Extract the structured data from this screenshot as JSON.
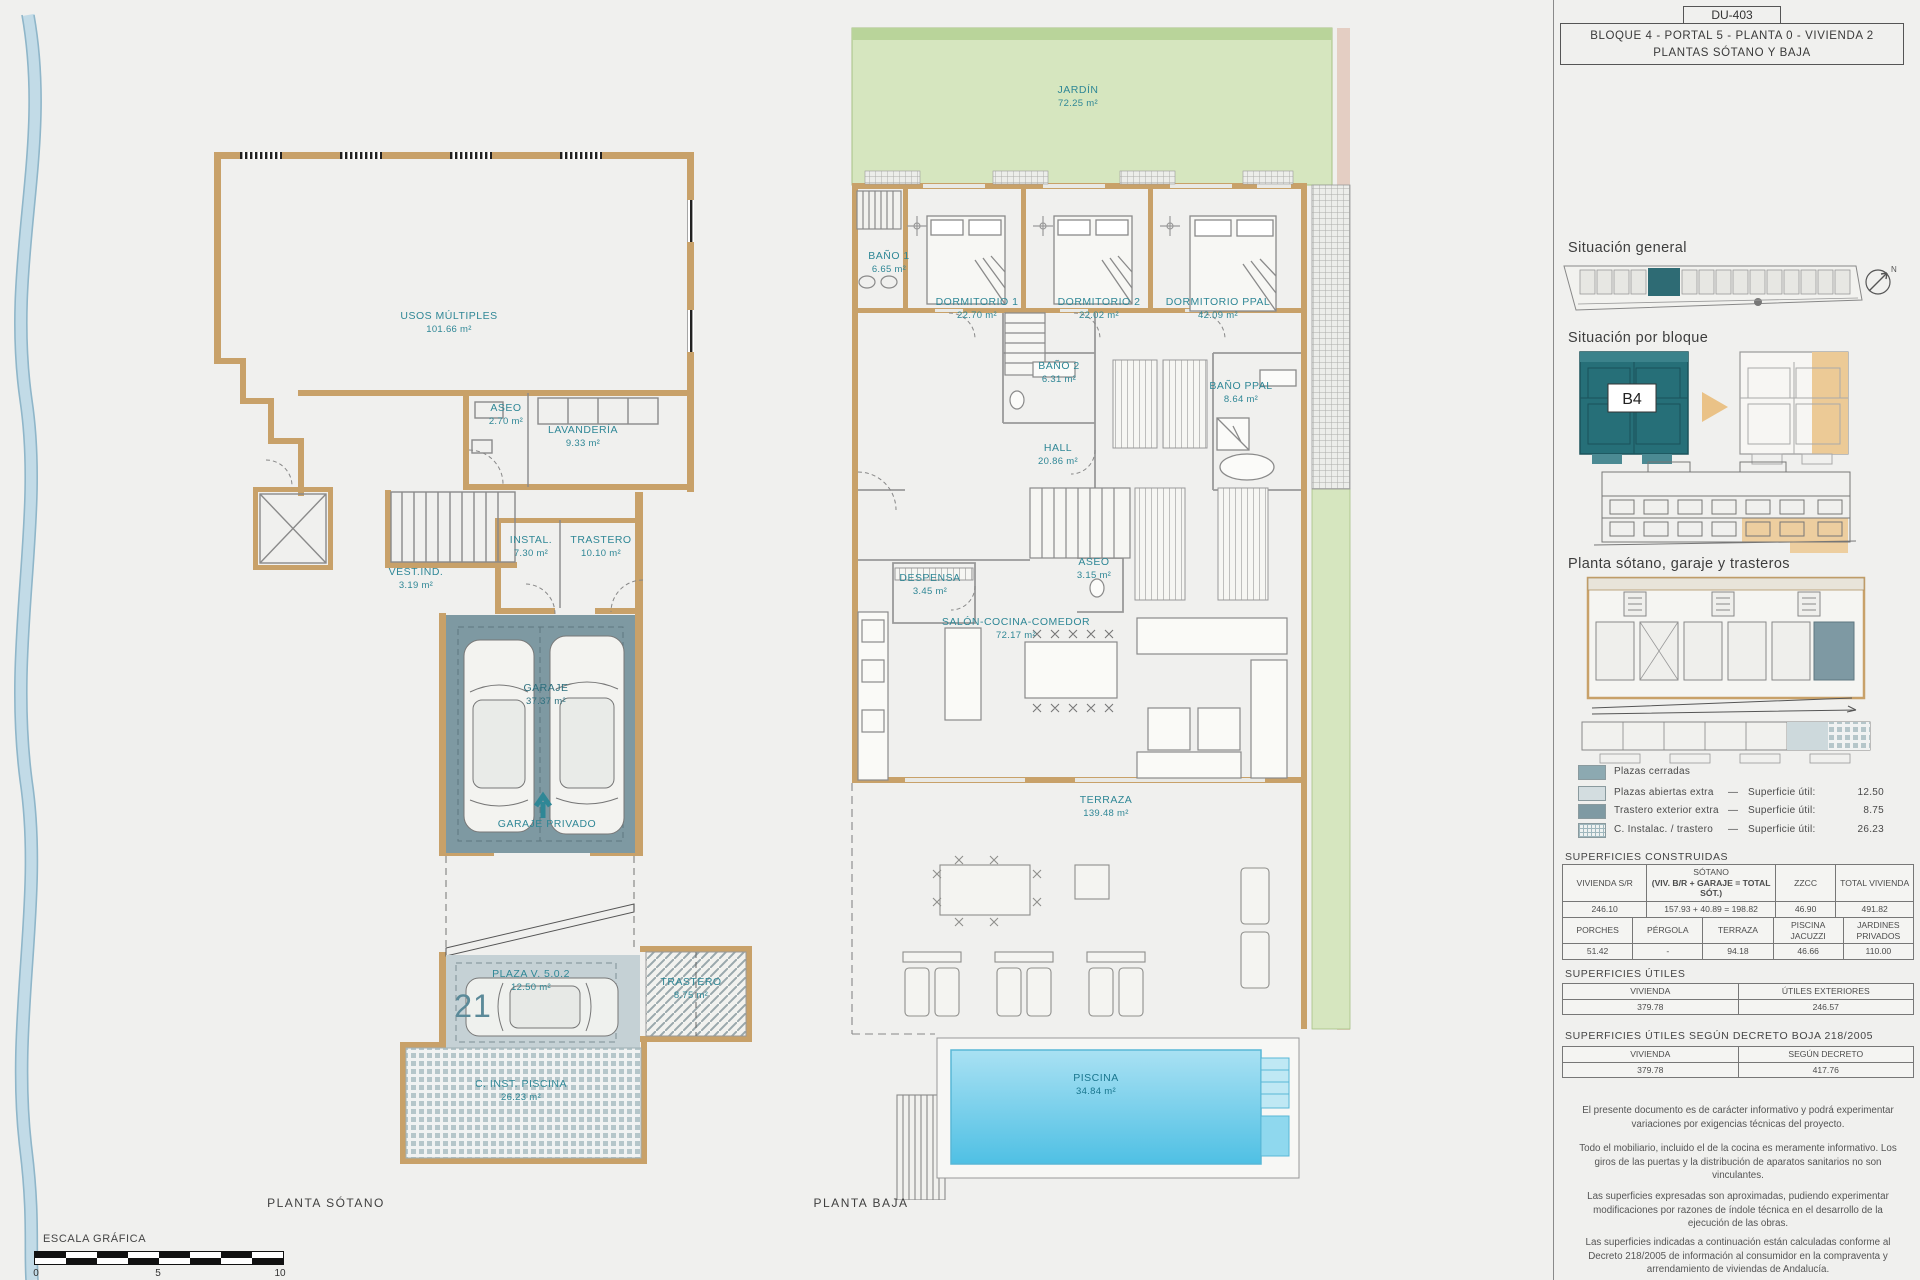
{
  "title_block": {
    "code": "DU-403",
    "line1": "BLOQUE 4 - PORTAL 5 - PLANTA 0 - VIVIENDA 2",
    "line2": "PLANTAS SÓTANO Y BAJA"
  },
  "sidebar": {
    "situacion_general_heading": "Situación general",
    "situacion_bloque_heading": "Situación por bloque",
    "bloque_label": "B4",
    "compass_label": "N",
    "planta_sotano_heading": "Planta sótano, garaje y trasteros",
    "legend": {
      "item1": {
        "label": "Plazas cerradas"
      },
      "item2": {
        "label": "Plazas abiertas extra",
        "dash": "—",
        "measure": "Superficie útil:",
        "value": "12.50"
      },
      "item3": {
        "label": "Trastero exterior extra",
        "dash": "—",
        "measure": "Superficie útil:",
        "value": "8.75"
      },
      "item4": {
        "label": "C. Instalac. / trastero",
        "dash": "—",
        "measure": "Superficie útil:",
        "value": "26.23"
      }
    },
    "construidas": {
      "heading": "SUPERFICIES CONSTRUIDAS",
      "t1h1": "VIVIENDA S/R",
      "t1h2a": "SÓTANO",
      "t1h2b": "(VIV. B/R + GARAJE = TOTAL SÓT.)",
      "t1h3": "ZZCC",
      "t1h4": "TOTAL VIVIENDA",
      "t1v1": "246.10",
      "t1v2": "157.93  +  40.89  =  198.82",
      "t1v3": "46.90",
      "t1v4": "491.82",
      "t2h1": "PORCHES",
      "t2h2": "PÉRGOLA",
      "t2h3": "TERRAZA",
      "t2h4": "PISCINA JACUZZI",
      "t2h5": "JARDINES PRIVADOS",
      "t2v1": "51.42",
      "t2v2": "-",
      "t2v3": "94.18",
      "t2v4": "46.66",
      "t2v5": "110.00"
    },
    "utiles": {
      "heading": "SUPERFICIES ÚTILES",
      "h1": "VIVIENDA",
      "h2": "ÚTILES EXTERIORES",
      "v1": "379.78",
      "v2": "246.57"
    },
    "decreto": {
      "heading": "SUPERFICIES ÚTILES SEGÚN DECRETO BOJA 218/2005",
      "h1": "VIVIENDA",
      "h2": "SEGÚN DECRETO",
      "v1": "379.78",
      "v2": "417.76"
    },
    "notes": {
      "p1": "El presente documento es de carácter informativo y podrá experimentar variaciones por exigencias técnicas del proyecto.",
      "p2": "Todo el mobiliario, incluido el de la cocina es meramente informativo. Los giros de las puertas y la distribución de aparatos sanitarios no son vinculantes.",
      "p3": "Las superficies expresadas son aproximadas, pudiendo experimentar modificaciones por razones de índole técnica en el desarrollo de la ejecución de las obras.",
      "p4": "Las superficies indicadas a continuación están calculadas conforme al Decreto 218/2005 de información al consumidor en la compraventa y arrendamiento de viviendas de Andalucía."
    }
  },
  "sotano": {
    "caption": "PLANTA SÓTANO",
    "usos_name": "USOS MÚLTIPLES",
    "usos_area": "101.66 m²",
    "aseo_name": "ASEO",
    "aseo_area": "2.70 m²",
    "lav_name": "LAVANDERÍA",
    "lav_area": "9.33 m²",
    "vest_name": "VEST.IND.",
    "vest_area": "3.19 m²",
    "instal_name": "INSTAL.",
    "instal_area": "7.30 m²",
    "trastero_name": "TRASTERO",
    "trastero_area": "10.10 m²",
    "garaje_name": "GARAJE",
    "garaje_area": "37.37 m²",
    "garaje_privado": "GARAJE PRIVADO",
    "plaza_name": "PLAZA V. 5.0.2",
    "plaza_area": "12.50 m²",
    "plaza_num": "21",
    "trastero_ext_name": "TRASTERO",
    "trastero_ext_area": "8.75 m²",
    "cinst_name": "C. INST. PISCINA",
    "cinst_area": "26.23 m²"
  },
  "baja": {
    "caption": "PLANTA BAJA",
    "jardin_name": "JARDÍN",
    "jardin_area": "72.25 m²",
    "bano1_name": "BAÑO 1",
    "bano1_area": "6.65 m²",
    "dorm1_name": "DORMITORIO 1",
    "dorm1_area": "22.70 m²",
    "dorm2_name": "DORMITORIO 2",
    "dorm2_area": "22.02 m²",
    "dormppal_name": "DORMITORIO PPAL",
    "dormppal_area": "42.09 m²",
    "bano2_name": "BAÑO 2",
    "bano2_area": "6.31 m²",
    "hall_name": "HALL",
    "hall_area": "20.86 m²",
    "banoppal_name": "BAÑO PPAL",
    "banoppal_area": "8.64 m²",
    "aseo_name": "ASEO",
    "aseo_area": "3.15 m²",
    "despensa_name": "DESPENSA",
    "despensa_area": "3.45 m²",
    "salon_name": "SALÓN-COCINA-COMEDOR",
    "salon_area": "72.17 m²",
    "terraza_name": "TERRAZA",
    "terraza_area": "139.48 m²",
    "piscina_name": "PISCINA",
    "piscina_area": "34.84 m²"
  },
  "scale_bar": {
    "label": "ESCALA GRÁFICA",
    "tick0": "0",
    "tick5": "5",
    "tick10": "10"
  },
  "colors": {
    "accent_teal": "#2f8796",
    "wall_tan": "#c8a169",
    "garage_teal": "#7e99a2",
    "garden_green": "#d6e6bf",
    "pool_blue": "#5ec7e8",
    "highlight_orange": "#ecca96",
    "block_teal": "#266f78"
  }
}
